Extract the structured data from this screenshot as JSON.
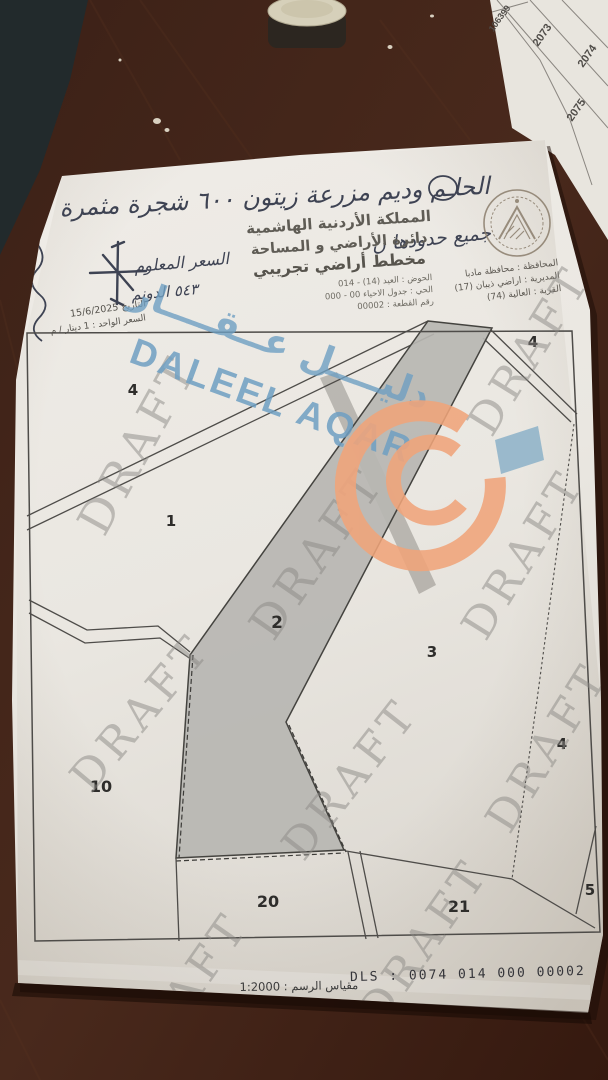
{
  "scene": {
    "desk_color": "#44261a",
    "mat_color": "#222a2c",
    "paper_color": "#edeae4",
    "parcel_fill": "#b7b6b2",
    "watermark_gray": "#8b8884",
    "brand_blue": "#6f9fc2",
    "logo_orange": "#f0a47a",
    "logo_flag_blue": "#8fb3c9"
  },
  "adjacent_sheet": {
    "numbers": [
      "99",
      "1063",
      "2073",
      "2074",
      "2075"
    ]
  },
  "handwriting": {
    "top_note": "الحاـم وديم مزرعة زيتون ٦٠٠ شجرة مثمرة",
    "right_note": "جميع حدودها ن",
    "price_note": "السعر المعلوم",
    "dunum_note": "٥٤٣ الدونم"
  },
  "header": {
    "kingdom": "المملكة الأردنية الهاشمية",
    "department": "دائرة الأراضي و المساحة",
    "title": "مخطط أراضي تجريبي",
    "basin": "الحوض : العيد (14) - 014",
    "district": "الحي : جدول الاحياء 00 - 000",
    "parcel_no": "رقم القطعة : 00002"
  },
  "admin": {
    "governorate": "المحافظة : محافظة مادبا",
    "directorate": "المديرية : اراضي ذيبان (17)",
    "village": "القرية : العالية (74)"
  },
  "margin": {
    "date_line": "التاريخ   15/6/2025",
    "price_line": "السعر الواحد : 1 دينار / م"
  },
  "watermark": {
    "draft": "DRAFT",
    "brand_latin": "DALEEL AQAR",
    "brand_arabic": "دليــــل عــقــــار"
  },
  "map": {
    "parcels": [
      {
        "label": "4"
      },
      {
        "label": "1"
      },
      {
        "label": "2"
      },
      {
        "label": "3"
      },
      {
        "label": "4"
      },
      {
        "label": "10"
      },
      {
        "label": "20"
      },
      {
        "label": "21"
      },
      {
        "label": "5"
      }
    ]
  },
  "footer": {
    "scale": "مقياس الرسم : 1:2000",
    "dls": "DLS : 0074 014 000 00002"
  }
}
